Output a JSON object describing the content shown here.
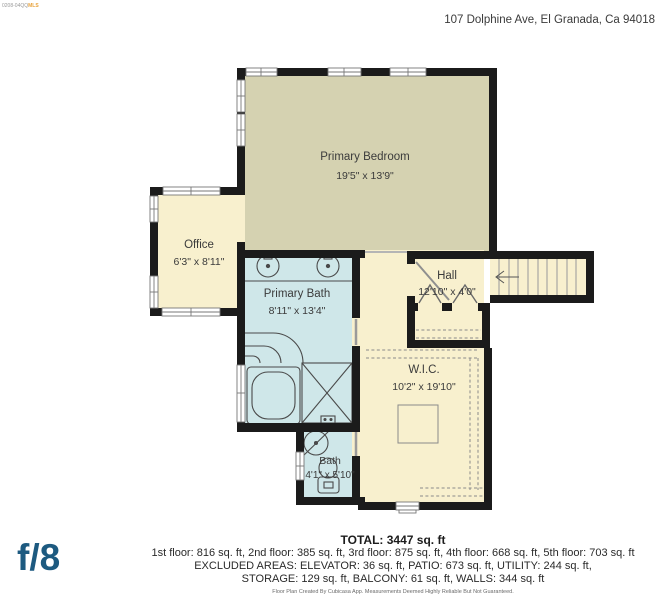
{
  "watermark": {
    "code": "0208-04QQ",
    "brand": "MLS"
  },
  "header": {
    "address": "107 Dolphine Ave, El Granada, Ca 94018"
  },
  "floorplan": {
    "rooms": [
      {
        "id": "primary-bedroom",
        "name": "Primary Bedroom",
        "dimensions": "19'5\" x 13'9\""
      },
      {
        "id": "office",
        "name": "Office",
        "dimensions": "6'3\" x 8'11\""
      },
      {
        "id": "primary-bath",
        "name": "Primary Bath",
        "dimensions": "8'11\" x 13'4\""
      },
      {
        "id": "hall",
        "name": "Hall",
        "dimensions": "12'10\" x 4'0\""
      },
      {
        "id": "wic",
        "name": "W.I.C.",
        "dimensions": "10'2\" x 19'10\""
      },
      {
        "id": "bath",
        "name": "Bath",
        "dimensions": "4'1\" x 5'10\""
      }
    ],
    "colors": {
      "bedroom_fill": "#d5d2b1",
      "closet_fill": "#f8f0ce",
      "bath_fill": "#cfe7e9",
      "wall": "#1b1b1b",
      "logo_blue": "#1d5a80",
      "mls_orange": "#e8a33d"
    }
  },
  "summary": {
    "total": "TOTAL: 3447 sq. ft",
    "floors": "1st floor: 816 sq. ft, 2nd floor: 385 sq. ft, 3rd floor: 875 sq. ft, 4th floor: 668 sq. ft, 5th floor: 703 sq. ft",
    "excluded_line1": "EXCLUDED AREAS: ELEVATOR: 36 sq. ft, PATIO: 673 sq. ft, UTILITY: 244 sq. ft,",
    "excluded_line2": "STORAGE: 129 sq. ft, BALCONY: 61 sq. ft, WALLS: 344 sq. ft"
  },
  "branding": {
    "logo": "f/8",
    "disclaimer": "Floor Plan Created By Cubicasa App. Measurements Deemed Highly Reliable But Not Guaranteed."
  }
}
